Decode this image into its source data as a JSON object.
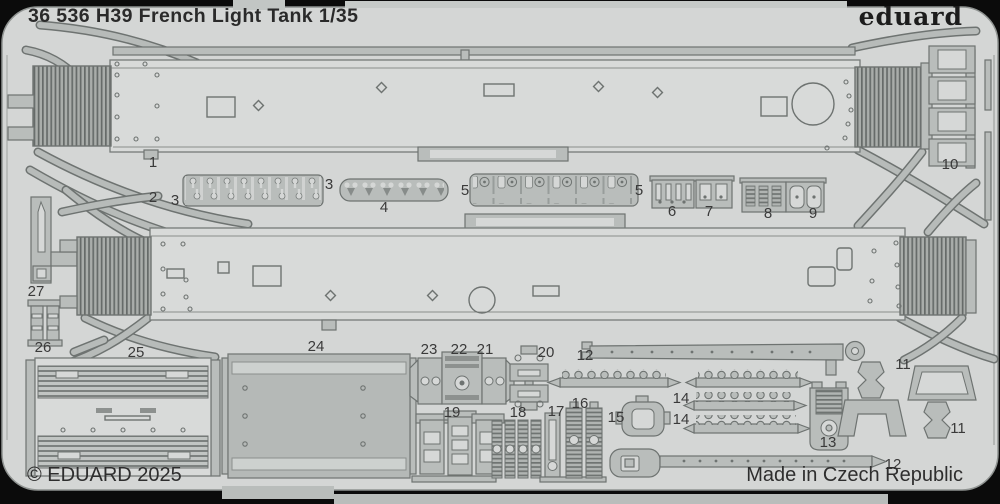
{
  "header": {
    "title": "36 536 H39 French Light Tank 1/35",
    "brand": "eduard"
  },
  "footer": {
    "copyright": "© EDUARD 2025",
    "origin": "Made in Czech Republic"
  },
  "sheet": {
    "kind": "photo-etched brass fret",
    "colors": {
      "background": "#0b0b0b",
      "sheet": "#d4d6d5",
      "part": "#b9bdbb",
      "part_dark": "#b5b9b7",
      "outline": "#6e7371",
      "text": "#2a2a2a"
    },
    "part_labels": [
      {
        "id": "1",
        "x": 153,
        "y": 167
      },
      {
        "id": "2",
        "x": 153,
        "y": 202
      },
      {
        "id": "3",
        "x": 175,
        "y": 205
      },
      {
        "id": "3",
        "x": 329,
        "y": 189
      },
      {
        "id": "4",
        "x": 384,
        "y": 212
      },
      {
        "id": "5",
        "x": 465,
        "y": 195
      },
      {
        "id": "5",
        "x": 639,
        "y": 195
      },
      {
        "id": "6",
        "x": 672,
        "y": 216
      },
      {
        "id": "7",
        "x": 709,
        "y": 216
      },
      {
        "id": "8",
        "x": 768,
        "y": 218
      },
      {
        "id": "9",
        "x": 813,
        "y": 218
      },
      {
        "id": "10",
        "x": 950,
        "y": 169
      },
      {
        "id": "27",
        "x": 36,
        "y": 296
      },
      {
        "id": "26",
        "x": 43,
        "y": 352
      },
      {
        "id": "25",
        "x": 136,
        "y": 357
      },
      {
        "id": "24",
        "x": 316,
        "y": 351
      },
      {
        "id": "23",
        "x": 429,
        "y": 354
      },
      {
        "id": "22",
        "x": 459,
        "y": 354
      },
      {
        "id": "21",
        "x": 485,
        "y": 354
      },
      {
        "id": "20",
        "x": 546,
        "y": 357
      },
      {
        "id": "12",
        "x": 585,
        "y": 360
      },
      {
        "id": "19",
        "x": 452,
        "y": 417
      },
      {
        "id": "18",
        "x": 518,
        "y": 417
      },
      {
        "id": "17",
        "x": 556,
        "y": 416
      },
      {
        "id": "16",
        "x": 580,
        "y": 408
      },
      {
        "id": "15",
        "x": 616,
        "y": 422
      },
      {
        "id": "14",
        "x": 681,
        "y": 403
      },
      {
        "id": "14",
        "x": 681,
        "y": 424
      },
      {
        "id": "13",
        "x": 828,
        "y": 447
      },
      {
        "id": "11",
        "x": 903,
        "y": 369
      },
      {
        "id": "11",
        "x": 958,
        "y": 433
      },
      {
        "id": "12",
        "x": 893,
        "y": 469
      }
    ]
  }
}
